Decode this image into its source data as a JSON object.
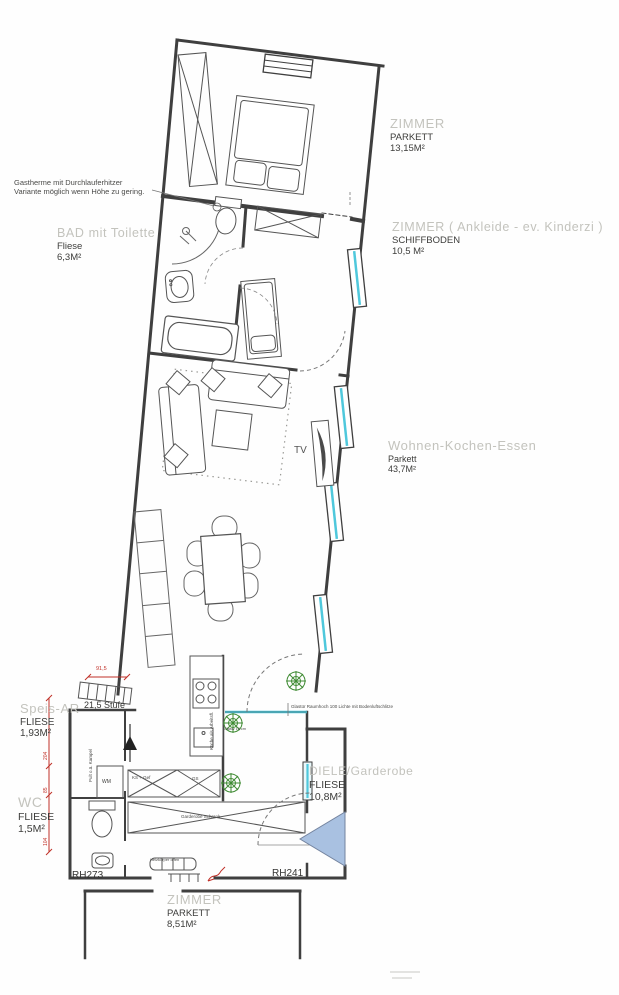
{
  "plan": {
    "rooms": [
      {
        "name": "BAD mit Toilette",
        "floor": "Fliese",
        "area": "6,3M²"
      },
      {
        "name": "ZIMMER",
        "floor": "PARKETT",
        "area": "13,15M²"
      },
      {
        "name": "ZIMMER ( Ankleide - ev.  Kinderzi )",
        "floor": "SCHIFFBODEN",
        "area": "10,5  M²"
      },
      {
        "name": "Wohnen-Kochen-Essen",
        "floor": "Parkett",
        "area": "43,7M²"
      },
      {
        "name": "Speis-AR",
        "floor": "FLIESE",
        "area": "1,93M²"
      },
      {
        "name": "WC",
        "floor": "FLIESE",
        "area": "1,5M²"
      },
      {
        "name": "DIELE/Garderobe",
        "floor": "FLIESE",
        "area": "10,8M²"
      },
      {
        "name": "ZIMMER",
        "floor": "PARKETT",
        "area": "8,51M²"
      }
    ],
    "notes": {
      "gastherme_line1": "Gastherme mit Durchlauferhitzer",
      "gastherme_line2": "Variante möglich wenn Höhe zu gering.",
      "glastuer": "Glastür Raumhoch 100 Lichte mit Bodenluftschlitze",
      "heizkoerper": "Heizkörper offen"
    },
    "annotations": {
      "stufe": "21,5 Stufe",
      "rh_left": "RH273",
      "rh_right": "RH241",
      "tv": "TV",
      "wm": "WM",
      "ks_gef": "KS + Gef",
      "gs": "GS",
      "garderobe_schrank": "Garderobe Schrank",
      "glas10": "Glasw 10 cm",
      "kueche_vertical": "Küche als Arbeitsfl.",
      "pult_vertical": "Pult o.ä. Kampel"
    },
    "dimensions": {
      "d1": "91,5",
      "d2": "204",
      "d3": "85",
      "d4": "104"
    },
    "colors": {
      "wall": "#3f3f3f",
      "window_glass": "#4fc8dc",
      "entry_arrow_fill": "#a9c1e1",
      "dim_red": "#c03028",
      "plant_green": "#3f8b33",
      "label_gray": "#c3c3bd"
    }
  }
}
